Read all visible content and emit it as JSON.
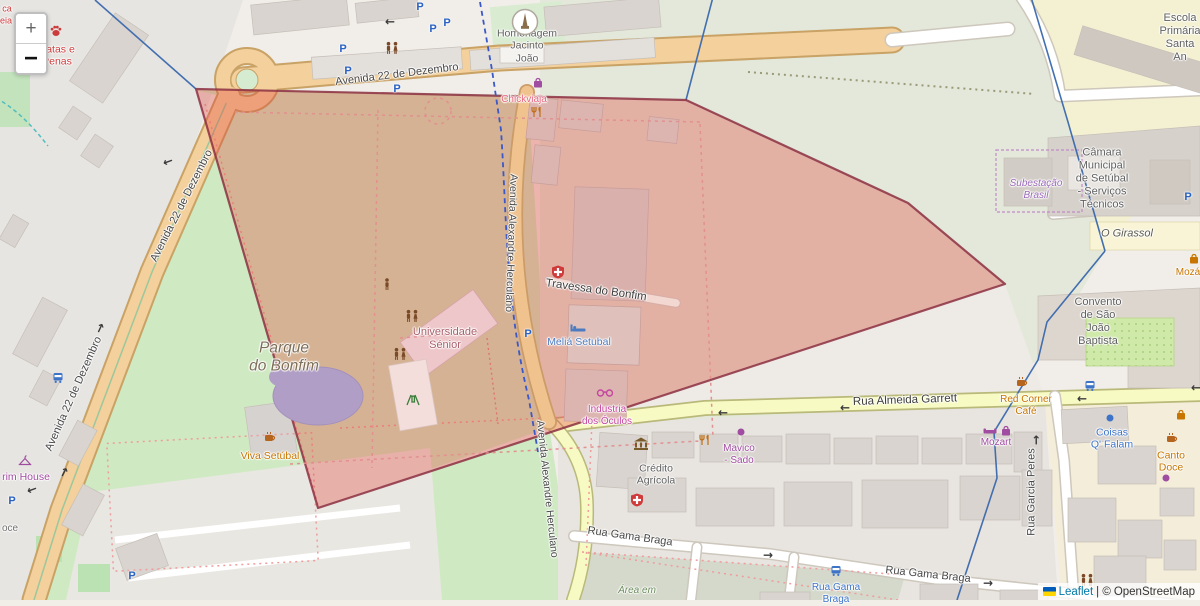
{
  "map": {
    "controls": {
      "zoom_in": "+",
      "zoom_out": "−"
    },
    "attribution": {
      "leaflet": "Leaflet",
      "separator": "| ©",
      "osm": "OpenStreetMap"
    },
    "overlay": {
      "fill": "#e23c31",
      "border": "#8c3042",
      "opacity": 0.32
    },
    "boundary_color": "#3a68ad",
    "labels": [
      {
        "id": "street-av22-top",
        "text": "Avenida 22 de Dezembro",
        "x": 397,
        "y": 75,
        "rot": -7,
        "size": 11,
        "color": "#474747"
      },
      {
        "id": "street-av22-mid",
        "text": "Avenida 22 de Dezembro",
        "x": 182,
        "y": 206,
        "rot": -63,
        "size": 11,
        "color": "#474747"
      },
      {
        "id": "street-av22-bottom",
        "text": "Avenida 22 de Dezembro",
        "x": 74,
        "y": 394,
        "rot": -66,
        "size": 11,
        "color": "#474747"
      },
      {
        "id": "street-herculano-1",
        "text": "Avenida Alexandre Herculano",
        "x": 511,
        "y": 243,
        "rot": 92,
        "size": 10.5,
        "color": "#474747"
      },
      {
        "id": "street-herculano-2",
        "text": "Avenida Alexandre Herculano",
        "x": 547,
        "y": 489,
        "rot": 84,
        "size": 10.5,
        "color": "#474747"
      },
      {
        "id": "street-travessa",
        "text": "Travessa do Bonfim",
        "x": 596,
        "y": 291,
        "rot": 8,
        "size": 11.5,
        "color": "#3d3d3d"
      },
      {
        "id": "street-garrett",
        "text": "Rua Almeida Garrett",
        "x": 905,
        "y": 401,
        "rot": -2,
        "size": 11.5,
        "color": "#3d3d3d"
      },
      {
        "id": "street-gama-1",
        "text": "Rua Gama Braga",
        "x": 630,
        "y": 537,
        "rot": 8,
        "size": 11,
        "color": "#474747"
      },
      {
        "id": "street-gama-2",
        "text": "Rua Gama Braga",
        "x": 928,
        "y": 575,
        "rot": 6,
        "size": 11,
        "color": "#474747"
      },
      {
        "id": "street-garcia",
        "text": "Rua Garcia Peres",
        "x": 1032,
        "y": 492,
        "rot": -90,
        "size": 11,
        "color": "#474747"
      },
      {
        "id": "poi-homenagem",
        "text": "Homenagem\nJacinto\nJoão",
        "x": 527,
        "y": 46,
        "rot": 0,
        "size": 10.5,
        "color": "#5f5f5f"
      },
      {
        "id": "area-parque",
        "text": "Parque\ndo Bonfim",
        "x": 284,
        "y": 358,
        "rot": 0,
        "size": 15.5,
        "color": "#7d6e58",
        "italic": true
      },
      {
        "id": "poi-universidade",
        "text": "Universidade\nSénior",
        "x": 445,
        "y": 339,
        "rot": 0,
        "size": 11,
        "color": "#a85f6a"
      },
      {
        "id": "poi-chickviaja",
        "text": "Chickviaja",
        "x": 524,
        "y": 100,
        "rot": 0,
        "size": 10,
        "color": "#e8647c"
      },
      {
        "id": "poi-melia",
        "text": "Meliá Setubal",
        "x": 579,
        "y": 342,
        "rot": 0,
        "size": 10.5,
        "color": "#4d7bc0"
      },
      {
        "id": "poi-industria",
        "text": "Industria\ndos Óculos",
        "x": 607,
        "y": 416,
        "rot": 0,
        "size": 10,
        "color": "#c546a0"
      },
      {
        "id": "poi-viva",
        "text": "Viva Setúbal",
        "x": 270,
        "y": 456,
        "rot": 0,
        "size": 10.5,
        "color": "#c77400"
      },
      {
        "id": "poi-subestacao",
        "text": "Subestação\nBrasil",
        "x": 1036,
        "y": 190,
        "rot": 0,
        "size": 10,
        "color": "#9a6ab8",
        "italic": true
      },
      {
        "id": "poi-camara",
        "text": "Câmara\nMunicipal\nde Setúbal\n- Serviços\nTécnicos",
        "x": 1102,
        "y": 179,
        "rot": 0,
        "size": 11,
        "color": "#5f5f5f"
      },
      {
        "id": "area-girassol",
        "text": "O Girassol",
        "x": 1127,
        "y": 234,
        "rot": 0,
        "size": 11,
        "color": "#5b5b4e",
        "italic": true
      },
      {
        "id": "poi-escola",
        "text": "Escola\nPrimária\nSanta An",
        "x": 1180,
        "y": 38,
        "rot": 0,
        "size": 11,
        "color": "#5f5f5f"
      },
      {
        "id": "poi-convento",
        "text": "Convento\nde São\nJoão\nBaptista",
        "x": 1098,
        "y": 322,
        "rot": 0,
        "size": 11,
        "color": "#5f5f5f"
      },
      {
        "id": "poi-moza",
        "text": "Mozá",
        "x": 1188,
        "y": 273,
        "rot": 0,
        "size": 10,
        "color": "#c77400"
      },
      {
        "id": "poi-red-corner",
        "text": "Red Corner\nCafé",
        "x": 1026,
        "y": 406,
        "rot": 0,
        "size": 10,
        "color": "#c77400"
      },
      {
        "id": "poi-mozart",
        "text": "Mozart",
        "x": 996,
        "y": 443,
        "rot": 0,
        "size": 10,
        "color": "#a04ca0"
      },
      {
        "id": "poi-mavico",
        "text": "Mavico\n- Sado",
        "x": 739,
        "y": 455,
        "rot": 0,
        "size": 10,
        "color": "#a04ca0"
      },
      {
        "id": "poi-credito",
        "text": "Crédito\nAgrícola",
        "x": 656,
        "y": 475,
        "rot": 0,
        "size": 10.5,
        "color": "#5f5f5f"
      },
      {
        "id": "poi-busstop-gama",
        "text": "Rua Gama\nBraga",
        "x": 836,
        "y": 594,
        "rot": 0,
        "size": 10,
        "color": "#3d74c8"
      },
      {
        "id": "poi-coisas",
        "text": "Coisas\nQ' Falam",
        "x": 1112,
        "y": 439,
        "rot": 0,
        "size": 10.5,
        "color": "#3d74c8"
      },
      {
        "id": "poi-canto-doce",
        "text": "Canto\nDoce",
        "x": 1171,
        "y": 462,
        "rot": 0,
        "size": 10.5,
        "color": "#c77400"
      },
      {
        "id": "poi-patas-penas",
        "text": "Patas e\nPenas",
        "x": 57,
        "y": 56,
        "rot": 0,
        "size": 10.5,
        "color": "#cc3b3b"
      },
      {
        "id": "area-area-em",
        "text": "Área em",
        "x": 637,
        "y": 591,
        "rot": 0,
        "size": 10,
        "color": "#6a8a5a",
        "italic": true
      },
      {
        "id": "poi-rim-house",
        "text": "rim House",
        "x": 26,
        "y": 477,
        "rot": 0,
        "size": 10.5,
        "color": "#a04ca0"
      },
      {
        "id": "poi-oce",
        "text": "oce",
        "x": 10,
        "y": 529,
        "rot": 0,
        "size": 10,
        "color": "#6f6f6f"
      },
      {
        "id": "poi-ca",
        "text": "ca",
        "x": 7,
        "y": 9,
        "rot": 0,
        "size": 9,
        "color": "#cc3b3b"
      },
      {
        "id": "poi-eia",
        "text": "eia",
        "x": 6,
        "y": 21,
        "rot": 0,
        "size": 9,
        "color": "#cc3b3b"
      }
    ],
    "icons": [
      {
        "type": "parking",
        "x": 420,
        "y": 6
      },
      {
        "type": "parking",
        "x": 433,
        "y": 28
      },
      {
        "type": "parking",
        "x": 447,
        "y": 22
      },
      {
        "type": "parking",
        "x": 343,
        "y": 48
      },
      {
        "type": "parking",
        "x": 348,
        "y": 70
      },
      {
        "type": "parking",
        "x": 397,
        "y": 88
      },
      {
        "type": "parking",
        "x": 528,
        "y": 333
      },
      {
        "type": "parking",
        "x": 1188,
        "y": 196
      },
      {
        "type": "parking",
        "x": 12,
        "y": 500
      },
      {
        "type": "parking",
        "x": 132,
        "y": 575
      },
      {
        "type": "bus",
        "x": 836,
        "y": 571
      },
      {
        "type": "bus",
        "x": 1090,
        "y": 386
      },
      {
        "type": "bus",
        "x": 58,
        "y": 378
      },
      {
        "type": "people",
        "x": 392,
        "y": 48
      },
      {
        "type": "people",
        "x": 412,
        "y": 316
      },
      {
        "type": "people",
        "x": 400,
        "y": 354
      },
      {
        "type": "people",
        "x": 1087,
        "y": 580
      },
      {
        "type": "person",
        "x": 387,
        "y": 284
      },
      {
        "type": "playground",
        "x": 413,
        "y": 400
      },
      {
        "type": "cafe",
        "x": 270,
        "y": 437
      },
      {
        "type": "cafe",
        "x": 1172,
        "y": 438
      },
      {
        "type": "cafe",
        "x": 1022,
        "y": 382
      },
      {
        "type": "restaurant",
        "x": 705,
        "y": 440
      },
      {
        "type": "restaurant",
        "x": 537,
        "y": 112
      },
      {
        "type": "glasses",
        "x": 605,
        "y": 393
      },
      {
        "type": "bed",
        "x": 578,
        "y": 328
      },
      {
        "type": "medcross",
        "x": 558,
        "y": 272
      },
      {
        "type": "medcross",
        "x": 637,
        "y": 500
      },
      {
        "type": "bank",
        "x": 641,
        "y": 444
      },
      {
        "type": "paw",
        "x": 56,
        "y": 31
      },
      {
        "type": "hanger",
        "x": 25,
        "y": 460
      },
      {
        "type": "shopbag-purple",
        "x": 538,
        "y": 83
      },
      {
        "type": "shopbag-purple",
        "x": 1006,
        "y": 431
      },
      {
        "type": "sofa",
        "x": 990,
        "y": 431
      },
      {
        "type": "dot-purple",
        "x": 741,
        "y": 432
      },
      {
        "type": "dot-purple",
        "x": 1166,
        "y": 478
      },
      {
        "type": "dot-blue",
        "x": 1110,
        "y": 418
      },
      {
        "type": "shopbag-orange",
        "x": 1181,
        "y": 415
      },
      {
        "type": "shopbag-orange",
        "x": 1194,
        "y": 259
      },
      {
        "type": "monument",
        "x": 525,
        "y": 22
      },
      {
        "type": "arrow",
        "x": 723,
        "y": 413,
        "rot": 180
      },
      {
        "type": "arrow",
        "x": 845,
        "y": 408,
        "rot": 180
      },
      {
        "type": "arrow",
        "x": 1082,
        "y": 399,
        "rot": 180
      },
      {
        "type": "arrow",
        "x": 1196,
        "y": 388,
        "rot": 180
      },
      {
        "type": "arrow",
        "x": 988,
        "y": 583,
        "rot": 0
      },
      {
        "type": "arrow",
        "x": 768,
        "y": 555,
        "rot": 0
      },
      {
        "type": "arrow",
        "x": 1036,
        "y": 440,
        "rot": -90
      },
      {
        "type": "arrow",
        "x": 168,
        "y": 162,
        "rot": 160
      },
      {
        "type": "arrow",
        "x": 100,
        "y": 328,
        "rot": -65
      },
      {
        "type": "arrow",
        "x": 32,
        "y": 490,
        "rot": 160
      },
      {
        "type": "arrow",
        "x": 64,
        "y": 472,
        "rot": -62
      },
      {
        "type": "arrow",
        "x": 390,
        "y": 22,
        "rot": 180
      }
    ]
  }
}
